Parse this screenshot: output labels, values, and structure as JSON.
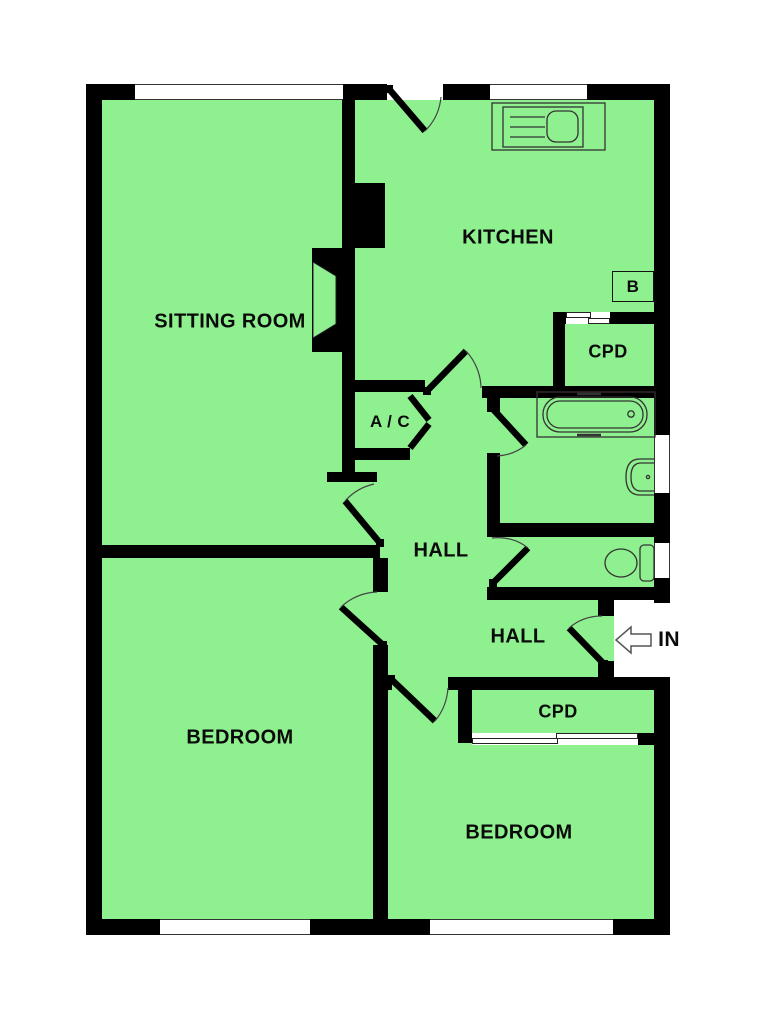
{
  "plan": {
    "colors": {
      "floor": "#8ff08f",
      "wall": "#000000",
      "line": "#333333",
      "background": "#ffffff"
    },
    "rooms": {
      "sitting_room": {
        "label": "SITTING ROOM"
      },
      "kitchen": {
        "label": "KITCHEN"
      },
      "hall_main": {
        "label": "HALL"
      },
      "hall_entrance": {
        "label": "HALL"
      },
      "bedroom_left": {
        "label": "BEDROOM"
      },
      "bedroom_right": {
        "label": "BEDROOM"
      },
      "cupboard_kitchen": {
        "label": "CPD"
      },
      "cupboard_bedroom": {
        "label": "CPD"
      },
      "airing_cupboard": {
        "label": "A / C"
      },
      "boiler": {
        "label": "B"
      }
    },
    "entrance": {
      "label": "IN"
    }
  }
}
